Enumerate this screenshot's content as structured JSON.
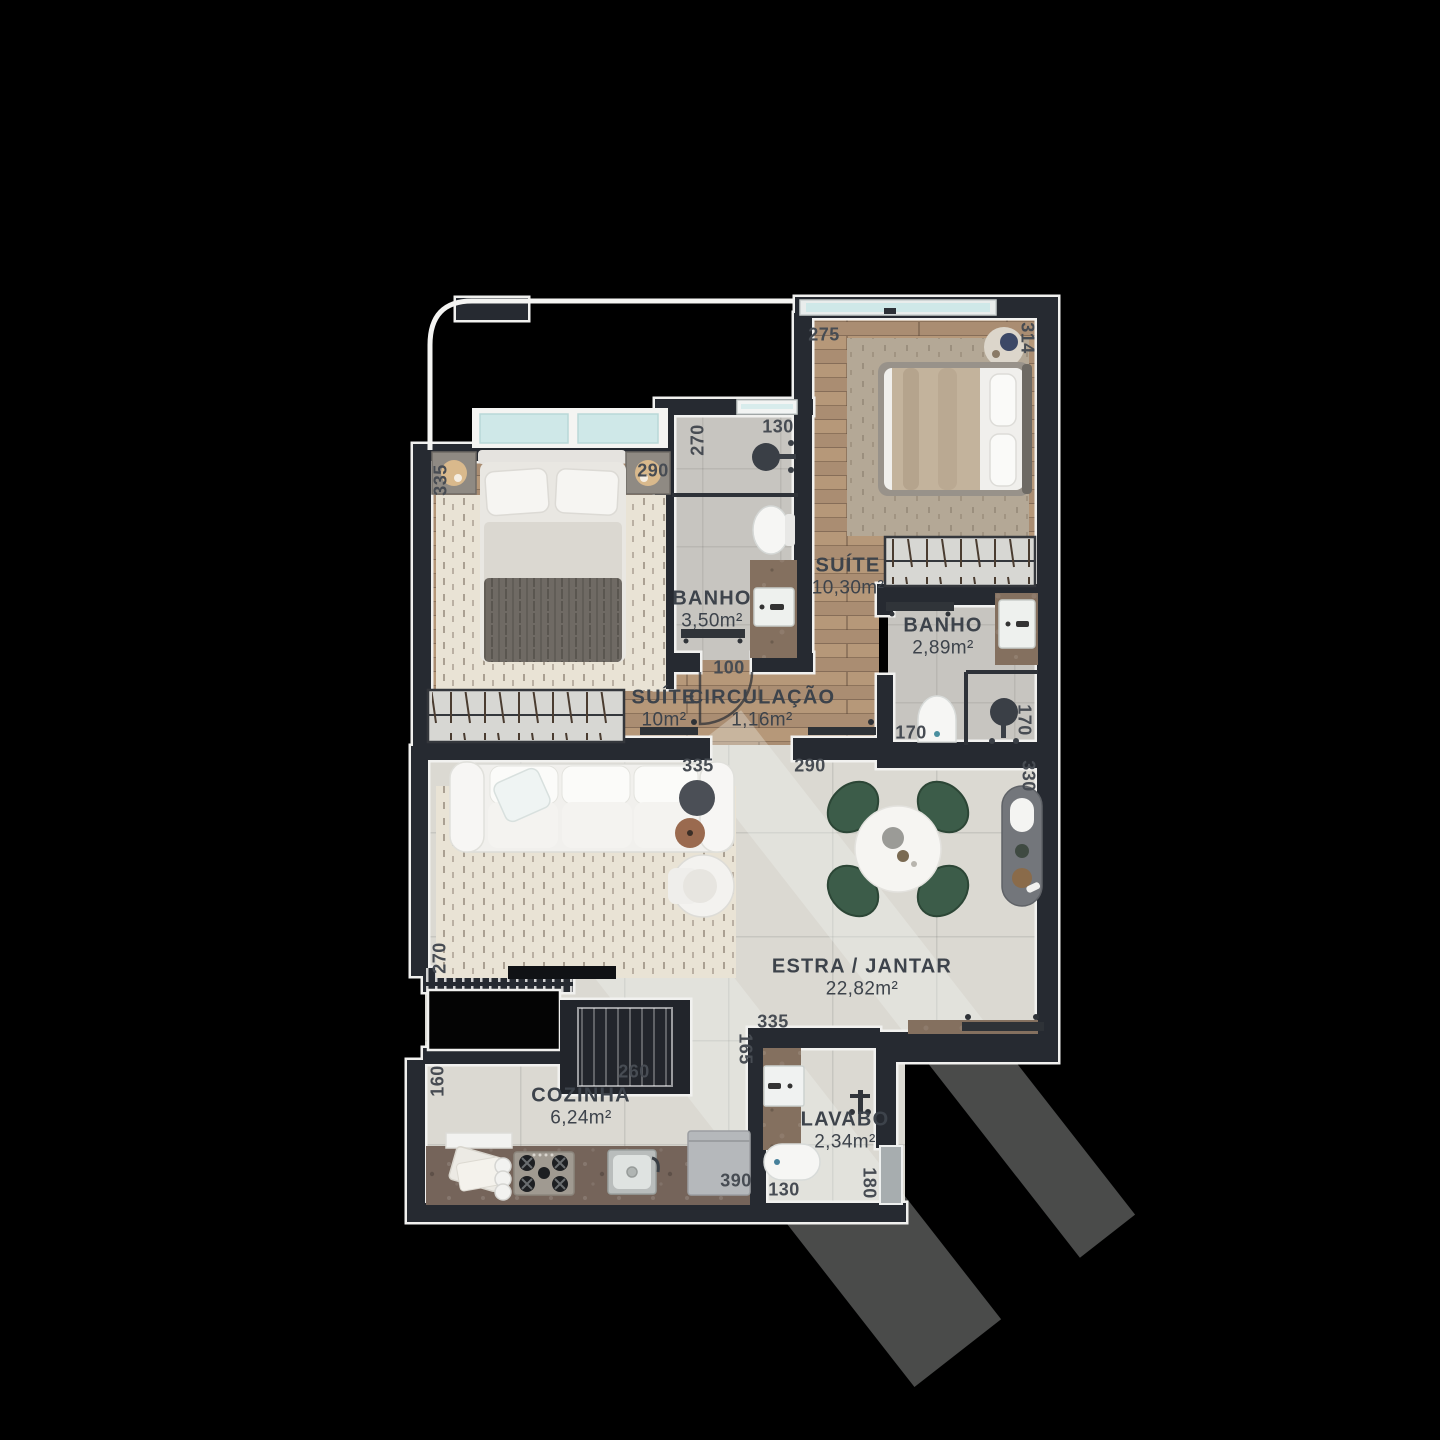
{
  "meta": {
    "type": "apartment-floor-plan",
    "view": "top-down 3d render",
    "background_color": "#000000"
  },
  "colors": {
    "wall": "#262a31",
    "wall_outline": "#f1f1ef",
    "wood_floor": "#b2947a",
    "bath_tile": "#c7c5c0",
    "living_tile": "#dbd9d2",
    "glass": "#cfe8e8",
    "marble_counter": "#84705f",
    "chair_green": "#3c5c49",
    "label_text": "#3d434b"
  },
  "rooms": [
    {
      "id": "suite-2",
      "name": "SUÍTE",
      "area": "10,30m²"
    },
    {
      "id": "banho-1",
      "name": "BANHO",
      "area": "3,50m²"
    },
    {
      "id": "suite-1",
      "name": "SUÍTE",
      "area": "10m²"
    },
    {
      "id": "circulacao",
      "name": "CIRCULAÇÃO",
      "area": "1,16m²"
    },
    {
      "id": "banho-2",
      "name": "BANHO",
      "area": "2,89m²"
    },
    {
      "id": "estar-jantar",
      "name": "ESTRA / JANTAR",
      "area": "22,82m²"
    },
    {
      "id": "cozinha",
      "name": "COZINHA",
      "area": "6,24m²"
    },
    {
      "id": "lavabo",
      "name": "LAVABO",
      "area": "2,34m²"
    }
  ],
  "dimensions": [
    {
      "id": "suite-2-top",
      "value": "275"
    },
    {
      "id": "suite-2-right",
      "value": "314"
    },
    {
      "id": "suite-1-left",
      "value": "335"
    },
    {
      "id": "suite-1-top",
      "value": "290"
    },
    {
      "id": "banho-1-left",
      "value": "270"
    },
    {
      "id": "banho-1-top",
      "value": "130"
    },
    {
      "id": "banho-1-door",
      "value": "100"
    },
    {
      "id": "banho-2-width",
      "value": "170"
    },
    {
      "id": "banho-2-right",
      "value": "170"
    },
    {
      "id": "living-top-left",
      "value": "335"
    },
    {
      "id": "living-top-mid",
      "value": "290"
    },
    {
      "id": "living-right",
      "value": "330"
    },
    {
      "id": "living-left",
      "value": "270"
    },
    {
      "id": "kitchen-left",
      "value": "160"
    },
    {
      "id": "kitchen-top",
      "value": "260"
    },
    {
      "id": "lavabo-top",
      "value": "335"
    },
    {
      "id": "lavabo-left",
      "value": "165"
    },
    {
      "id": "kitchen-fridge",
      "value": "390"
    },
    {
      "id": "lavabo-bottom",
      "value": "130"
    },
    {
      "id": "lavabo-right",
      "value": "180"
    }
  ],
  "furniture": [
    "double-bed",
    "wardrobe",
    "nightstand",
    "table-lamp",
    "rug",
    "sofa",
    "armchair",
    "side-table",
    "tv",
    "dining-table",
    "dining-chair",
    "sideboard",
    "wall-shelf",
    "kitchen-counter",
    "stove",
    "kitchen-sink",
    "fridge",
    "washbasin",
    "toilet",
    "shower-head",
    "glass-partition",
    "sliding-glass-door",
    "window",
    "balcony-railing",
    "door",
    "shaft",
    "void"
  ]
}
